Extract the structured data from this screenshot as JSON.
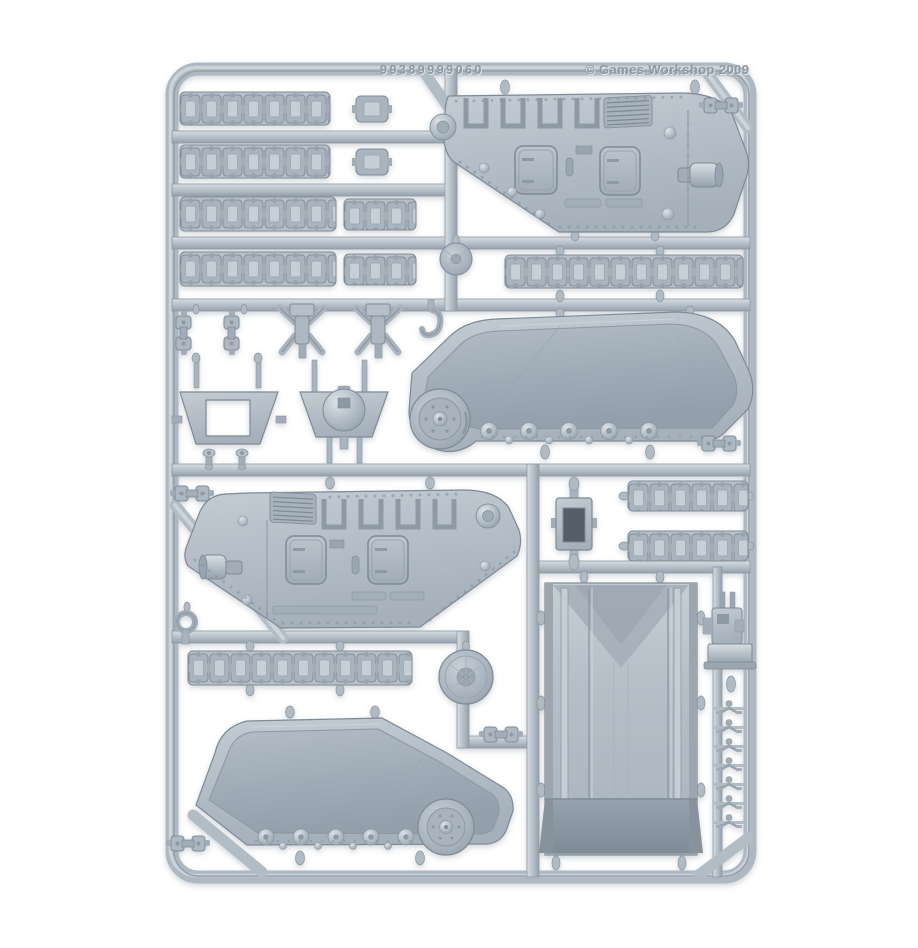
{
  "meta": {
    "description": "Product photograph of a plastic model kit sprue (tank hull frame) in light blue-grey plastic on a plain white background",
    "subject": "Games Workshop tank hull sprue with track links, hull side panels, lower hull panels and assault ramp"
  },
  "colors": {
    "background": "#ffffff",
    "plastic_base": "#b4bec7",
    "plastic_highlight": "#d8dde2",
    "plastic_shadow": "#94a0ab",
    "plastic_outline": "#7e8a96",
    "recess_dark": "#545e68",
    "embossed_text": "#8d98a3"
  },
  "embossing": {
    "product_code": "99389999060",
    "copyright": "© Games Workshop 2009"
  },
  "parts": [
    {
      "name": "track-link-strip",
      "count": 10
    },
    {
      "name": "single-track-link",
      "count": 2
    },
    {
      "name": "hull-side-panel",
      "count": 2
    },
    {
      "name": "lower-hull-track-panel",
      "count": 2
    },
    {
      "name": "assault-ramp-door",
      "count": 1
    },
    {
      "name": "vision-block",
      "count": 1
    },
    {
      "name": "road-wheel",
      "count": 2
    },
    {
      "name": "suspension-mount",
      "count": 2
    },
    {
      "name": "hinge-bracket",
      "count": 6
    },
    {
      "name": "tow-hook",
      "count": 2
    },
    {
      "name": "mudguard-frame",
      "count": 1
    },
    {
      "name": "domed-hatch",
      "count": 1
    },
    {
      "name": "weapon-mount",
      "count": 1
    },
    {
      "name": "door-handle",
      "count": 7
    },
    {
      "name": "end-cap",
      "count": 2
    }
  ]
}
